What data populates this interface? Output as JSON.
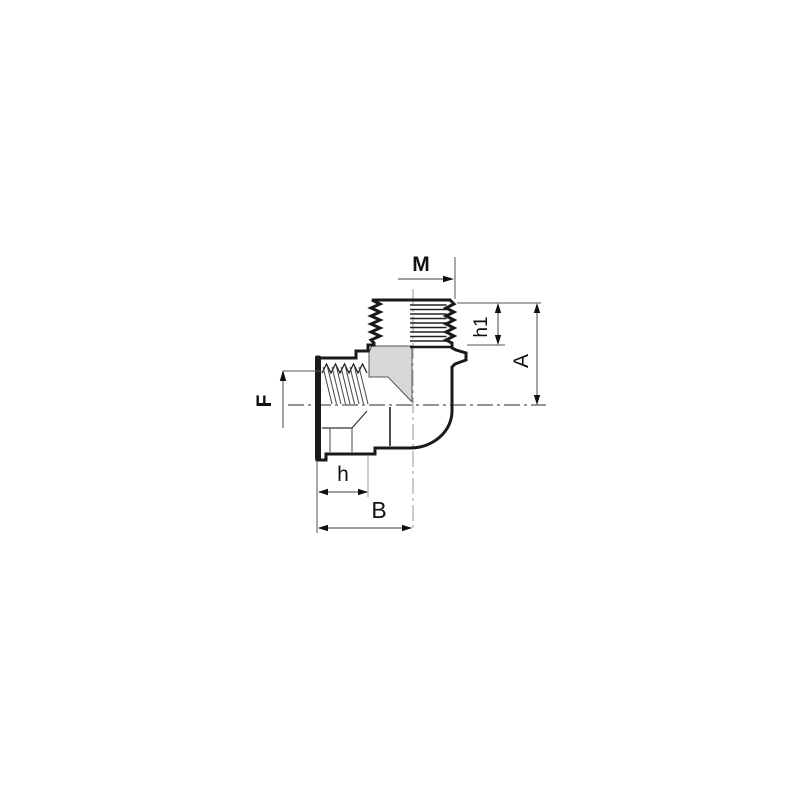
{
  "drawing": {
    "labels": {
      "male_thread_size": "M",
      "male_thread_length": "h1",
      "axis_height": "A",
      "female_thread_size": "F",
      "socket_depth": "h",
      "axis_width": "B"
    },
    "palette": {
      "background": "#ffffff",
      "outline": "#1a1a1a",
      "shading": "#d8d8d8",
      "dimension_lines": "#666666",
      "vertical_centerline": "#a8a8a8",
      "horizontal_centerline": "#555555",
      "text": "#111111"
    }
  }
}
